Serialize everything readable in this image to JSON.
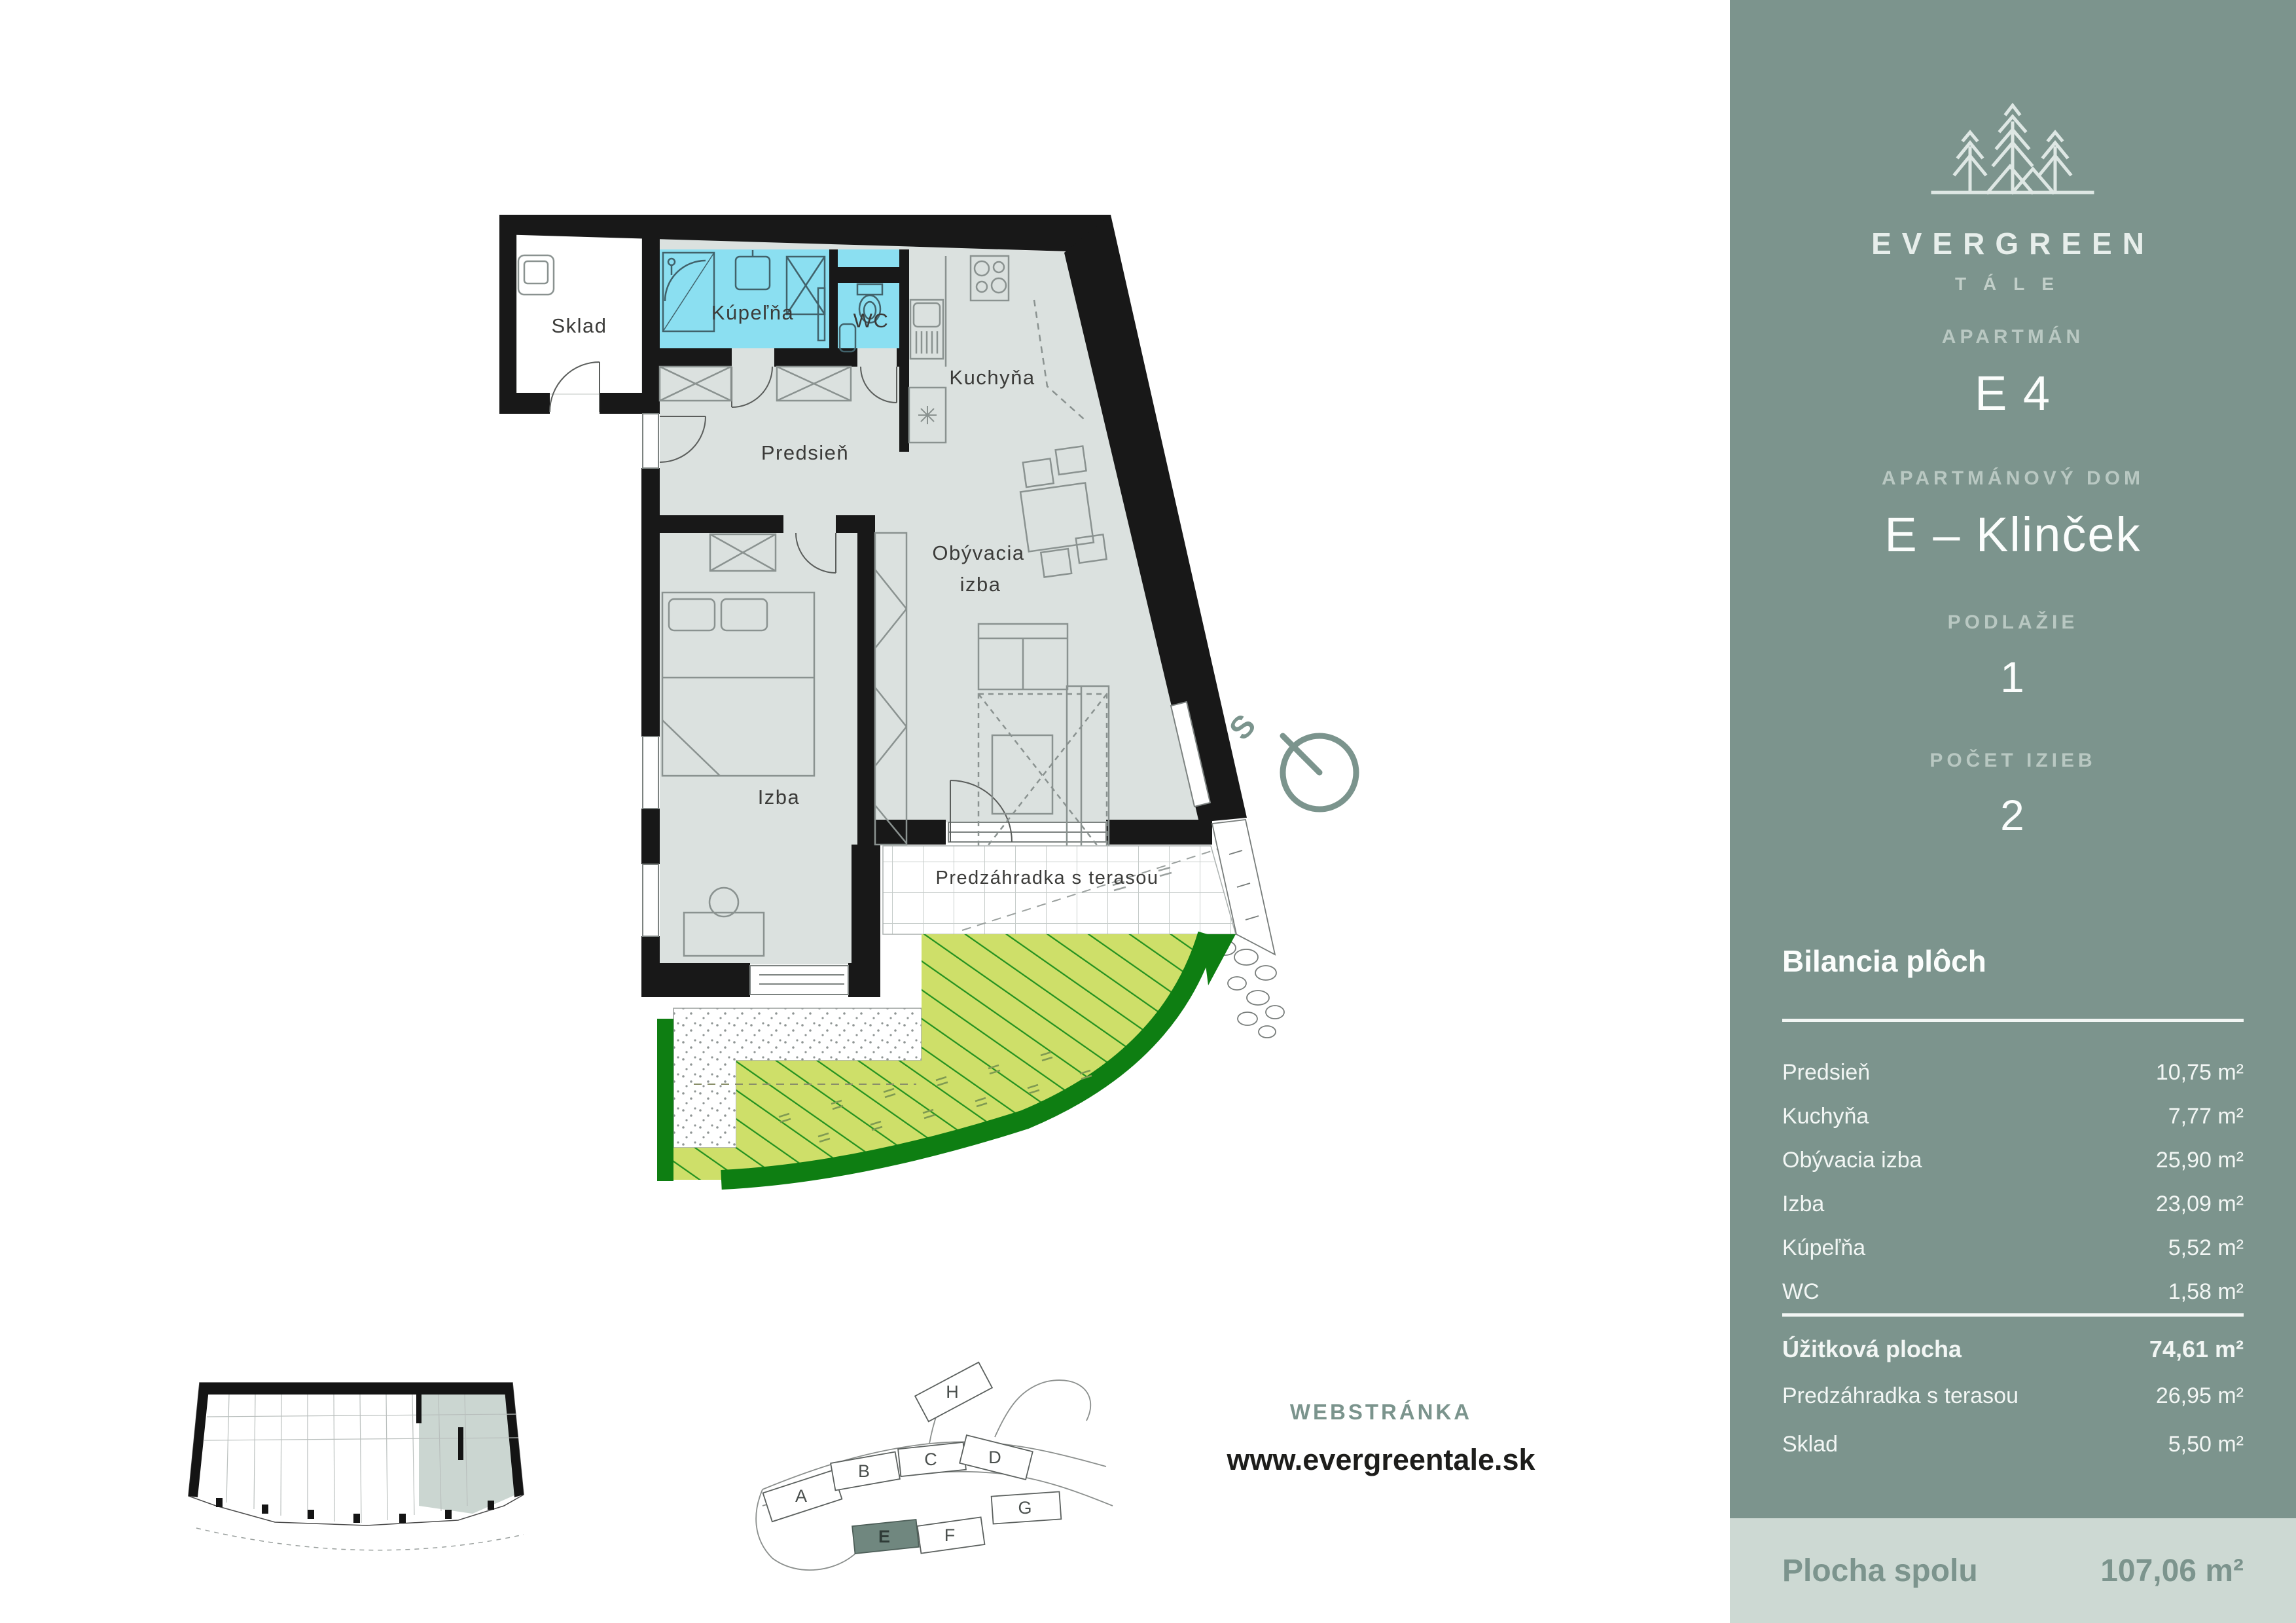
{
  "brand": {
    "name": "EVERGREEN",
    "sub": "TÁLE"
  },
  "sidebar": {
    "fields": [
      {
        "label": "APARTMÁN",
        "value": "E 4"
      },
      {
        "label": "APARTMÁNOVÝ DOM",
        "value": "E – Klinček"
      },
      {
        "label": "PODLAŽIE",
        "value": "1"
      },
      {
        "label": "POČET IZIEB",
        "value": "2"
      }
    ],
    "balance": {
      "title": "Bilancia plôch",
      "rows": [
        {
          "label": "Predsieň",
          "value": "10,75 m²"
        },
        {
          "label": "Kuchyňa",
          "value": "7,77 m²"
        },
        {
          "label": "Obývacia izba",
          "value": "25,90 m²"
        },
        {
          "label": "Izba",
          "value": "23,09 m²"
        },
        {
          "label": "Kúpeľňa",
          "value": "5,52 m²"
        },
        {
          "label": "WC",
          "value": "1,58 m²"
        }
      ],
      "summary": [
        {
          "label": "Úžitková plocha",
          "value": "74,61 m²"
        },
        {
          "label": "Predzáhradka s terasou",
          "value": "26,95 m²"
        },
        {
          "label": "Sklad",
          "value": "5,50 m²"
        }
      ]
    },
    "total": {
      "label": "Plocha spolu",
      "value": "107,06 m²"
    }
  },
  "floorplan": {
    "rooms": {
      "sklad": "Sklad",
      "kupelna": "Kúpeľňa",
      "wc": "WC",
      "kuchyna": "Kuchyňa",
      "predsien": "Predsieň",
      "obyvacia_line1": "Obývacia",
      "obyvacia_line2": "izba",
      "izba": "Izba",
      "terasa": "Predzáhradka s terasou"
    },
    "compass": "S"
  },
  "sitemap": {
    "buildings": [
      "A",
      "B",
      "C",
      "D",
      "E",
      "F",
      "G",
      "H"
    ],
    "highlighted": "E"
  },
  "website": {
    "label": "WEBSTRÁNKA",
    "url": "www.evergreentale.sk"
  },
  "colors": {
    "sidebar": "#7C948D",
    "panel": "#CDD9D3",
    "muted_label": "#B9C8C2",
    "bath_cyan": "#8BDFF1",
    "floor_gray": "#DBE1DF",
    "garden_yellow": "#CEDF69",
    "garden_dark": "#0E7E12",
    "wall_black": "#181818"
  }
}
